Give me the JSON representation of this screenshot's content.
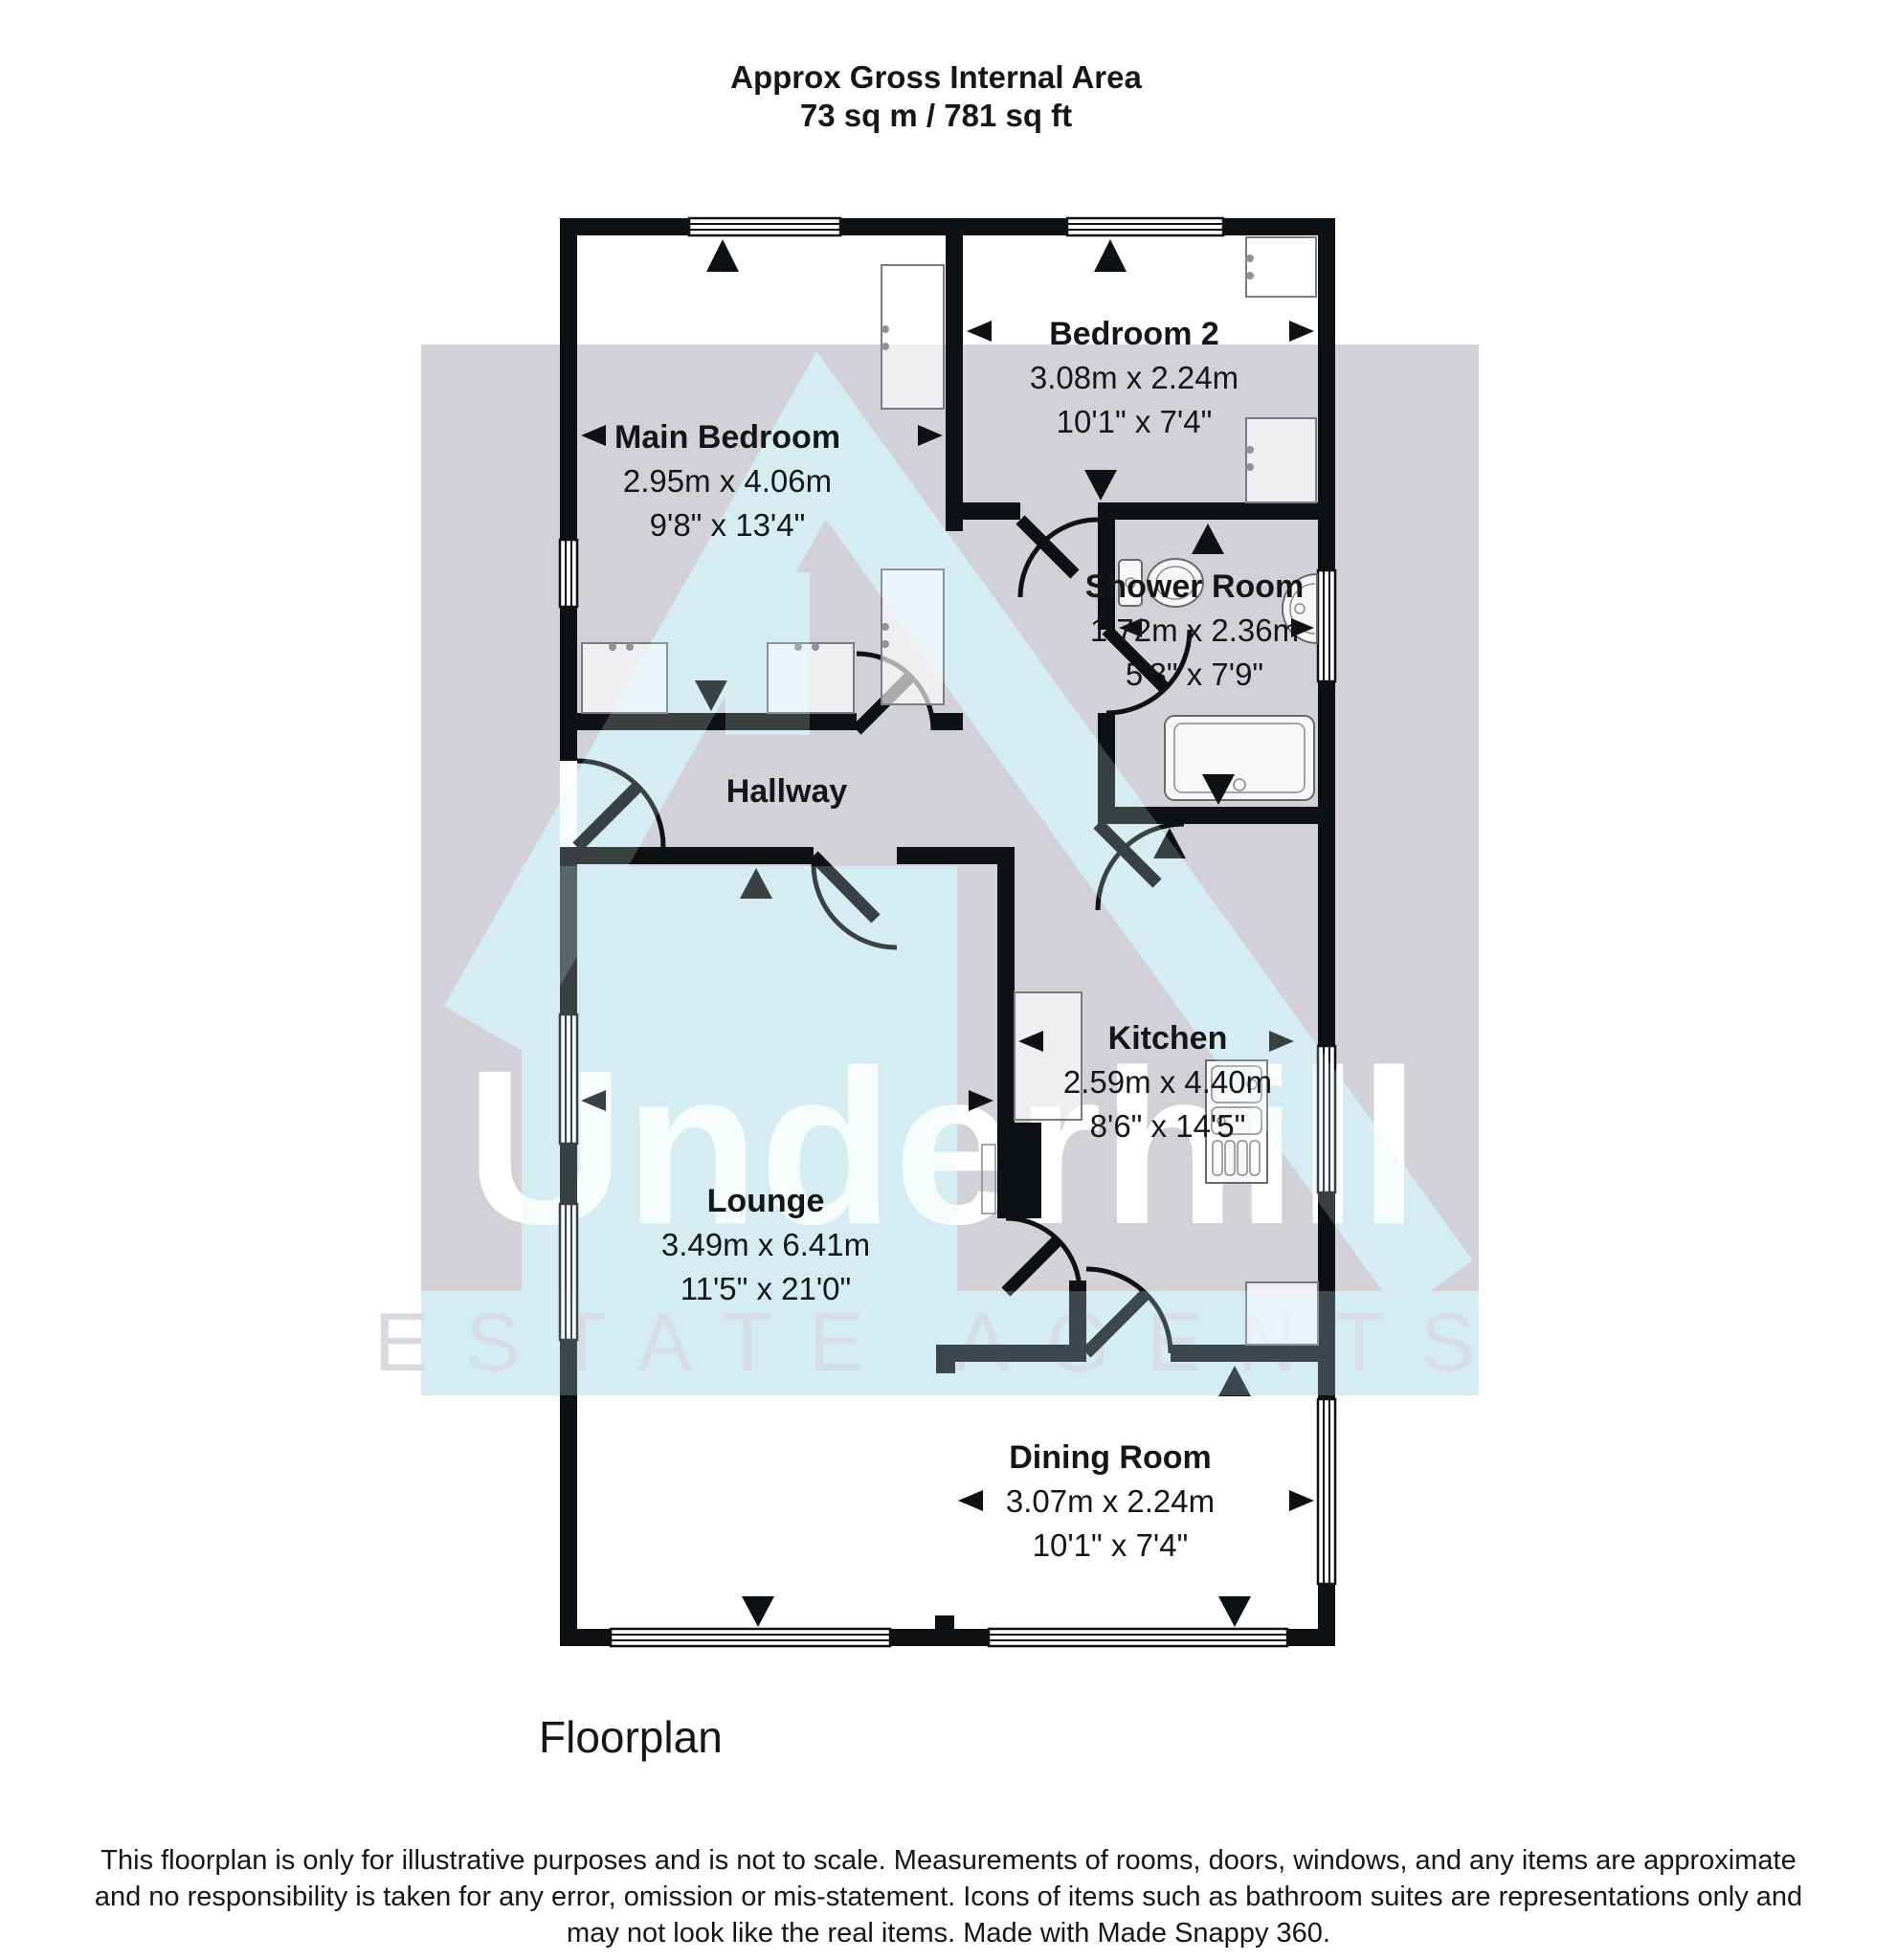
{
  "header": {
    "title_line1": "Approx Gross Internal Area",
    "title_line2": "73 sq m / 781 sq ft"
  },
  "watermark": {
    "brand": "Underhill",
    "tagline": "ESTATE AGENTS",
    "colors": {
      "grey_panel": "#d2d1d8",
      "blue_panel": "#d5ecf3",
      "brand_text": "#ffffff"
    }
  },
  "rooms": [
    {
      "id": "main-bedroom",
      "name": "Main Bedroom",
      "metric": "2.95m x 4.06m",
      "imperial": "9'8\" x 13'4\""
    },
    {
      "id": "bedroom-2",
      "name": "Bedroom 2",
      "metric": "3.08m x 2.24m",
      "imperial": "10'1\" x 7'4\""
    },
    {
      "id": "shower-room",
      "name": "Shower Room",
      "metric": "1.72m x 2.36m",
      "imperial": "5'8\" x 7'9\""
    },
    {
      "id": "hallway",
      "name": "Hallway",
      "metric": "",
      "imperial": ""
    },
    {
      "id": "kitchen",
      "name": "Kitchen",
      "metric": "2.59m x 4.40m",
      "imperial": "8'6\" x 14'5\""
    },
    {
      "id": "lounge",
      "name": "Lounge",
      "metric": "3.49m x 6.41m",
      "imperial": "11'5\" x 21'0\""
    },
    {
      "id": "dining-room",
      "name": "Dining Room",
      "metric": "3.07m x 2.24m",
      "imperial": "10'1\" x 7'4\""
    }
  ],
  "fixtures": {
    "toilet": "toilet-icon",
    "basin": "basin-icon",
    "shower_tray": "shower-tray-icon",
    "kitchen_sink": "kitchen-sink-icon",
    "wardrobe": "wardrobe-icon",
    "window": "window-icon",
    "door": "door-icon"
  },
  "footer": {
    "caption": "Floorplan",
    "disclaimer_line1": "This floorplan is only for illustrative purposes and is not to scale. Measurements of rooms, doors, windows, and any items are approximate",
    "disclaimer_line2": "and no responsibility is taken for any error, omission or mis-statement. Icons of items such as bathroom suites are representations only and",
    "disclaimer_line3": "may not look like the real items. Made with Made Snappy 360."
  },
  "colors": {
    "wall": "#0d1113",
    "fixture_outline": "#6a6a6a"
  }
}
